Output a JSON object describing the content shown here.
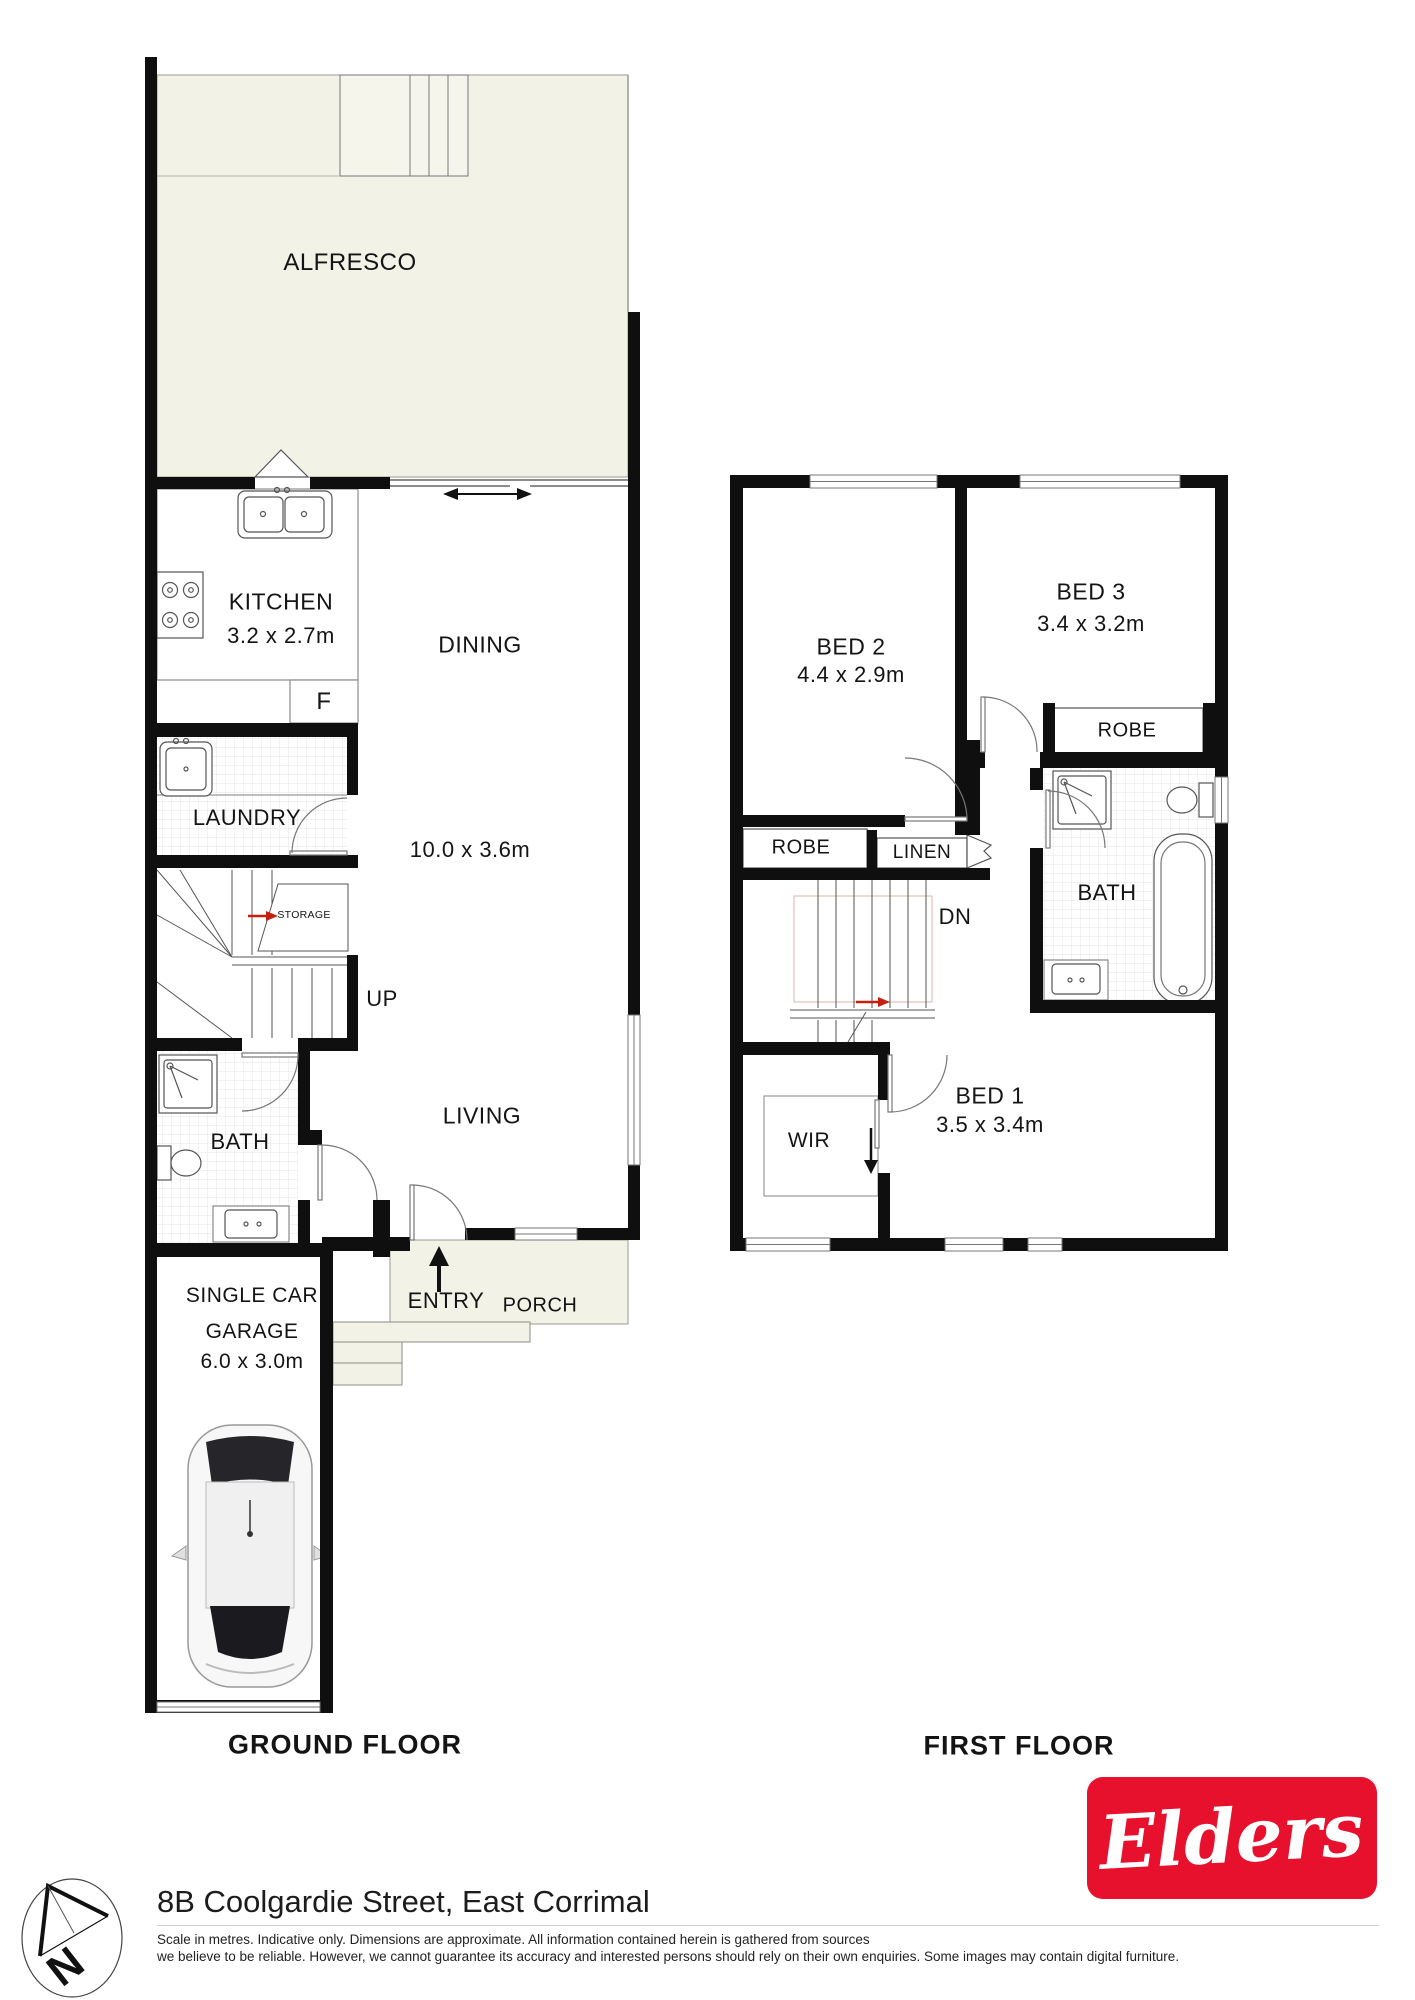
{
  "ground_floor": {
    "title": "GROUND FLOOR",
    "rooms": {
      "alfresco": "ALFRESCO",
      "kitchen": "KITCHEN",
      "kitchen_dims": "3.2 x 2.7m",
      "dining": "DINING",
      "living_dining_dims": "10.0 x 3.6m",
      "fridge": "F",
      "laundry": "LAUNDRY",
      "storage": "STORAGE",
      "stair_up": "UP",
      "bath": "BATH",
      "living": "LIVING",
      "entry": "ENTRY",
      "porch": "PORCH",
      "garage_line1": "SINGLE CAR",
      "garage_line2": "GARAGE",
      "garage_dims": "6.0 x 3.0m"
    }
  },
  "first_floor": {
    "title": "FIRST FLOOR",
    "rooms": {
      "bed2": "BED 2",
      "bed2_dims": "4.4 x 2.9m",
      "bed3": "BED 3",
      "bed3_dims": "3.4 x 3.2m",
      "robe_bed3": "ROBE",
      "robe_bed2": "ROBE",
      "linen": "LINEN",
      "stair_down": "DN",
      "bath": "BATH",
      "wir": "WIR",
      "bed1": "BED 1",
      "bed1_dims": "3.5 x 3.4m"
    }
  },
  "footer": {
    "address": "8B Coolgardie Street, East Corrimal",
    "disclaimer_line1": "Scale in metres. Indicative only. Dimensions are approximate. All information contained herein is gathered from sources",
    "disclaimer_line2": "we believe to be reliable. However, we cannot guarantee its accuracy and interested persons should rely on their own enquiries. Some images may contain digital furniture.",
    "compass_label": "N",
    "brand_name": "Elders"
  },
  "colors": {
    "wall": "#0f0f0f",
    "outdoor_fill": "#f3f2e6",
    "brand_red": "#e8112d",
    "arrow_red": "#c42010"
  }
}
